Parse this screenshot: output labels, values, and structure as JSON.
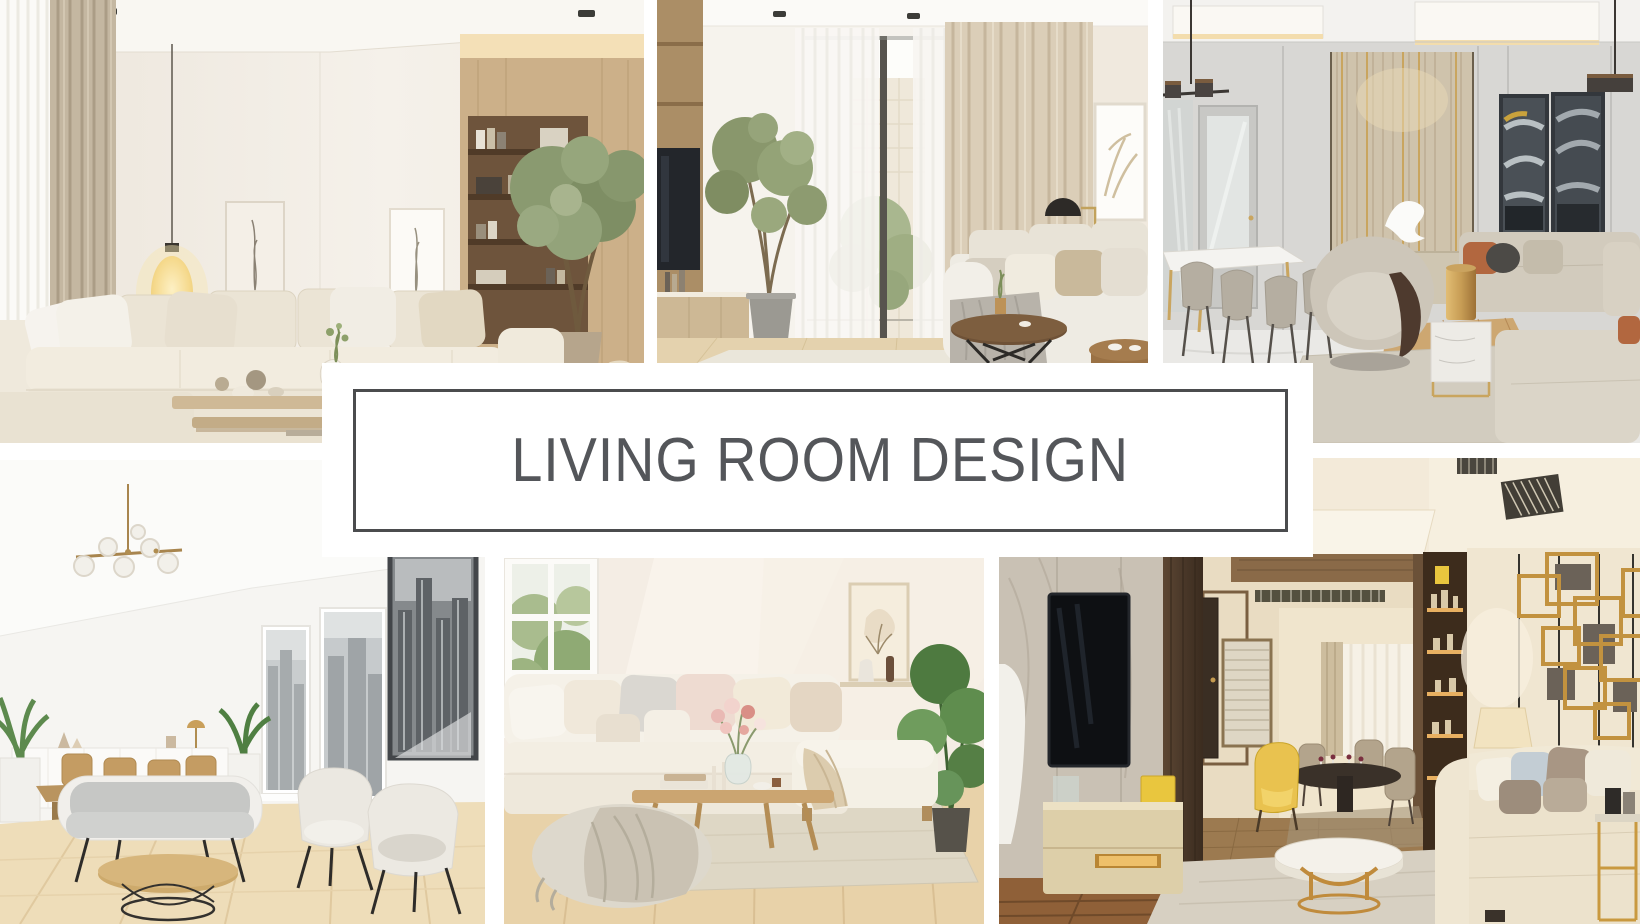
{
  "banner": {
    "title": "LIVING ROOM DESIGN"
  },
  "colors": {
    "canvas_bg": "#ffffff",
    "banner_bg": "#ffffff",
    "banner_border": "#4b4c4e",
    "title_color": "#54565a"
  },
  "photos": {
    "top_left": {
      "label": "beige sectional living room with wood shelving, indoor tree and glowing floor lamp"
    },
    "top_middle": {
      "label": "living room with tall window, sheer curtains, ficus tree, round coffee table and white sofa"
    },
    "top_right": {
      "label": "gray lounge with dining table, fluted feature wall, abstract art and gold lamp"
    },
    "bottom_left": {
      "label": "white scandinavian living room with city view windows, gray sofa and round wood coffee table"
    },
    "bottom_middle": {
      "label": "cream corner sofa with pillows, knit pouf, flowers on wood coffee table and house plant"
    },
    "bottom_right": {
      "label": "modern apartment with marble TV wall, hallway dining nook, gold wall art and cream sofa"
    }
  }
}
